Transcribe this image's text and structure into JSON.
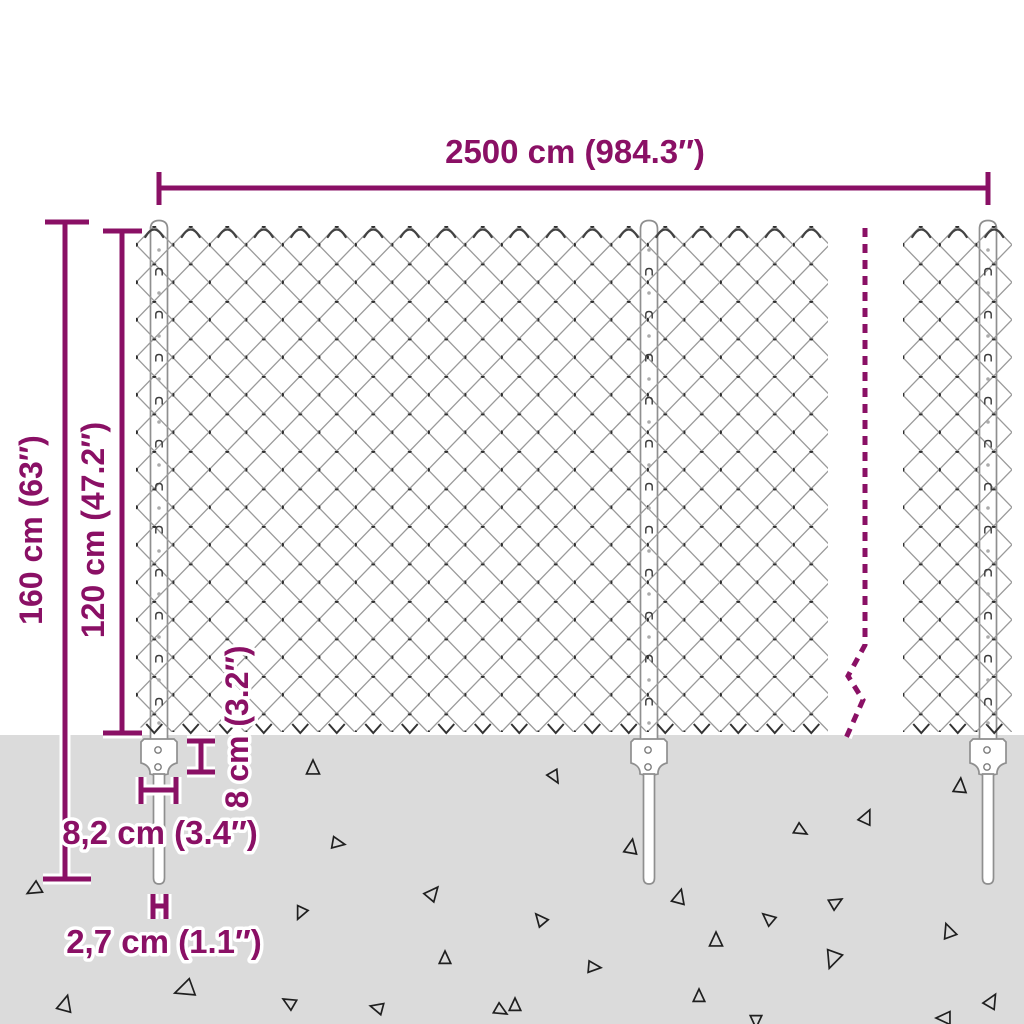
{
  "diagram": {
    "type": "product-dimension-diagram",
    "subject": "chain-link fence with posts and ground anchors",
    "labels": {
      "width": "2500 cm (984.3″)",
      "total_height": "160 cm (63″)",
      "mesh_height": "120 cm (47.2″)",
      "anchor_height": "8 cm (3.2″)",
      "anchor_width": "8,2 cm (3.4″)",
      "post_diameter": "2,7 cm (1.1″)"
    },
    "colors": {
      "dimension": "#8A1065",
      "ground": "#DBDBDB",
      "mesh_wire": "#9A9A9A",
      "mesh_knot": "#2E2E2E",
      "post_fill": "#FFFFFF",
      "post_stroke": "#8F8F8F",
      "debris": "#1F1F1F"
    },
    "ground_y": 735,
    "posts": [
      {
        "x": 159
      },
      {
        "x": 649
      },
      {
        "x": 988
      }
    ],
    "mesh_sections": [
      {
        "x0": 136,
        "x1": 828
      },
      {
        "x0": 903,
        "x1": 1012
      }
    ],
    "break_line": {
      "points": "865,228 865,645 848,676 863,700 846,738"
    },
    "triangles": [
      {
        "x": 313,
        "y": 769,
        "s": 9,
        "r": 0
      },
      {
        "x": 337,
        "y": 843,
        "s": 8,
        "r": 100
      },
      {
        "x": 432,
        "y": 894,
        "s": 9,
        "r": 40
      },
      {
        "x": 301,
        "y": 912,
        "s": 8,
        "r": 205
      },
      {
        "x": 186,
        "y": 989,
        "s": 12,
        "r": 250
      },
      {
        "x": 65,
        "y": 1005,
        "s": 10,
        "r": 15
      },
      {
        "x": 290,
        "y": 1003,
        "s": 8,
        "r": 300
      },
      {
        "x": 378,
        "y": 1008,
        "s": 8,
        "r": 285
      },
      {
        "x": 35,
        "y": 889,
        "s": 9,
        "r": 240
      },
      {
        "x": 554,
        "y": 776,
        "s": 8,
        "r": 150
      },
      {
        "x": 960,
        "y": 787,
        "s": 9,
        "r": 5
      },
      {
        "x": 866,
        "y": 818,
        "s": 9,
        "r": 25
      },
      {
        "x": 800,
        "y": 830,
        "s": 8,
        "r": 120
      },
      {
        "x": 631,
        "y": 848,
        "s": 9,
        "r": 10
      },
      {
        "x": 541,
        "y": 920,
        "s": 8,
        "r": 320
      },
      {
        "x": 679,
        "y": 898,
        "s": 9,
        "r": 15
      },
      {
        "x": 769,
        "y": 919,
        "s": 8,
        "r": 310
      },
      {
        "x": 835,
        "y": 903,
        "s": 8,
        "r": 60
      },
      {
        "x": 949,
        "y": 932,
        "s": 9,
        "r": 340
      },
      {
        "x": 716,
        "y": 941,
        "s": 9,
        "r": 0
      },
      {
        "x": 593,
        "y": 967,
        "s": 8,
        "r": 95
      },
      {
        "x": 833,
        "y": 958,
        "s": 11,
        "r": 200
      },
      {
        "x": 699,
        "y": 997,
        "s": 8,
        "r": 0
      },
      {
        "x": 991,
        "y": 1002,
        "s": 9,
        "r": 30
      },
      {
        "x": 515,
        "y": 1006,
        "s": 8,
        "r": 0
      },
      {
        "x": 756,
        "y": 1020,
        "s": 8,
        "r": 180
      },
      {
        "x": 945,
        "y": 1018,
        "s": 9,
        "r": 270
      },
      {
        "x": 445,
        "y": 959,
        "s": 8,
        "r": 0
      },
      {
        "x": 500,
        "y": 1010,
        "s": 8,
        "r": 120
      }
    ]
  }
}
